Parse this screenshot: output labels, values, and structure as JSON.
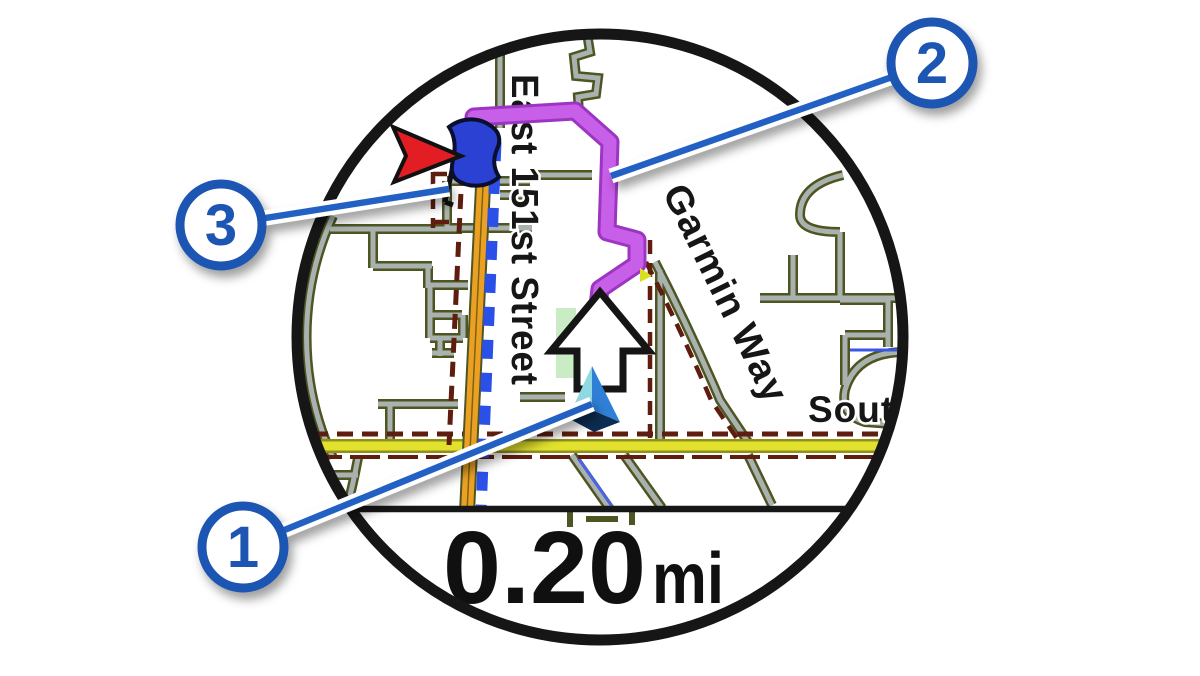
{
  "map": {
    "street_labels": {
      "vertical": "East 151st Street",
      "diagonal": "Garmin Way",
      "right_clipped": "Sout"
    },
    "data_field": {
      "value": "0.20",
      "unit": "mi"
    },
    "icons": {
      "destination": "destination-flag-icon",
      "heading_pointer": "red-arrow-icon",
      "maneuver": "turn-ahead-arrow-icon",
      "position": "current-position-triangle-icon"
    },
    "colors": {
      "bezel": "#161616",
      "route_magenta": "#c85fe8",
      "highway_orange": "#eca023",
      "road_yellow": "#e2e22e",
      "road_gray": "#a9b2ae",
      "road_casing": "#4d5623",
      "boundary_maroon": "#5e1d0e",
      "dash_blue": "#2b50e8",
      "park_green": "#c9ecc4",
      "callout_blue": "#1d55b2",
      "leader_blue": "#2360c4"
    }
  },
  "callouts": [
    {
      "label": "1"
    },
    {
      "label": "2"
    },
    {
      "label": "3"
    }
  ]
}
